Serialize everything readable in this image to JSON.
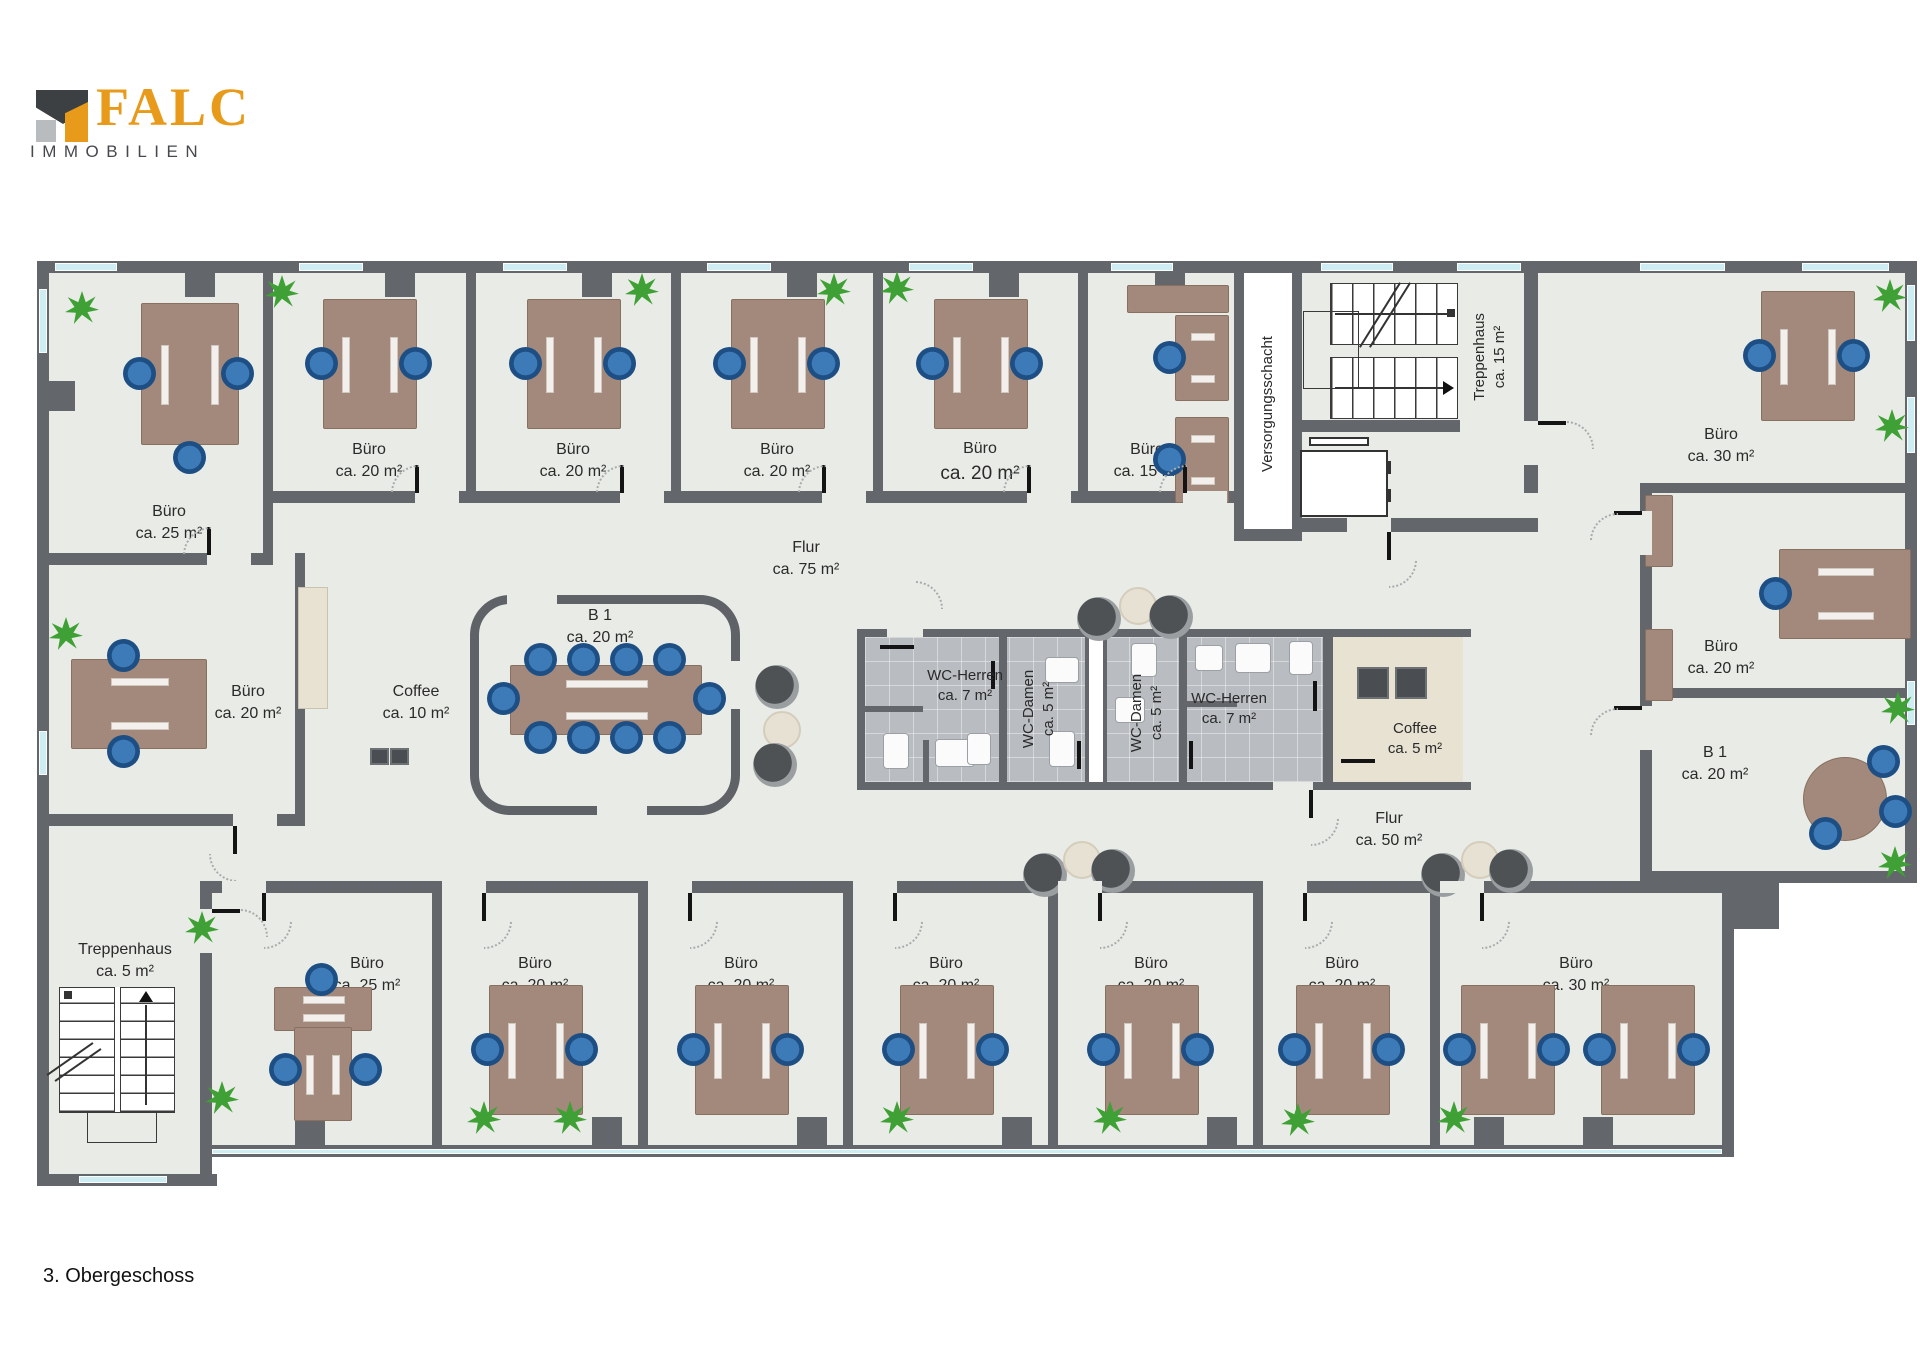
{
  "logo": {
    "brand": "FALC",
    "subtitle": "IMMOBILIEN"
  },
  "floor_label": "3. Obergeschoss",
  "colors": {
    "wall": "#63666a",
    "floor": "#e9ece6",
    "window": "#cdedf3",
    "wc_tile": "#b9bdc2",
    "beige": "#e8e2d3",
    "desk": "#a2897b",
    "chair": "#2e6da8",
    "plant": "#3fa135",
    "logo_orange": "#e89b1b",
    "logo_gray": "#45484d"
  },
  "rooms": {
    "top": [
      {
        "name": "Büro",
        "area": "ca. 25 m²"
      },
      {
        "name": "Büro",
        "area": "ca. 20 m²"
      },
      {
        "name": "Büro",
        "area": "ca. 20 m²"
      },
      {
        "name": "Büro",
        "area": "ca. 20 m²"
      },
      {
        "name": "Büro",
        "area": "ca. 20 m²"
      },
      {
        "name": "Büro",
        "area": "ca. 15 m²"
      }
    ],
    "shaft_label": "Versorgungsschacht",
    "stair_top": {
      "name": "Treppenhaus",
      "area": "ca. 15 m²"
    },
    "top_right": {
      "name": "Büro",
      "area": "ca. 30 m²"
    },
    "right": [
      {
        "name": "Büro",
        "area": "ca. 20 m²"
      },
      {
        "name": "B 1",
        "area": "ca. 20 m²"
      }
    ],
    "middle": [
      {
        "name": "Büro",
        "area": "ca. 20 m²"
      },
      {
        "name": "Coffee",
        "area": "ca. 10 m²"
      },
      {
        "name": "B 1",
        "area": "ca. 20 m²"
      }
    ],
    "wc": [
      {
        "name": "WC-Herren",
        "area": "ca. 7 m²"
      },
      {
        "name": "WC-Damen",
        "area": "ca. 5 m²"
      },
      {
        "name": "WC-Damen",
        "area": "ca. 5 m²"
      },
      {
        "name": "WC-Herren",
        "area": "ca. 7 m²"
      }
    ],
    "coffee_small": {
      "name": "Coffee",
      "area": "ca. 5 m²"
    },
    "corridor_top": {
      "name": "Flur",
      "area": "ca. 75 m²"
    },
    "corridor_bottom": {
      "name": "Flur",
      "area": "ca. 50 m²"
    },
    "stair_bottom": {
      "name": "Treppenhaus",
      "area": "ca. 5 m²"
    },
    "bottom": [
      {
        "name": "Büro",
        "area": "ca. 25 m²"
      },
      {
        "name": "Büro",
        "area": "ca. 20 m²"
      },
      {
        "name": "Büro",
        "area": "ca. 20 m²"
      },
      {
        "name": "Büro",
        "area": "ca. 20 m²"
      },
      {
        "name": "Büro",
        "area": "ca. 20 m²"
      },
      {
        "name": "Büro",
        "area": "ca. 20 m²"
      },
      {
        "name": "Büro",
        "area": "ca. 30 m²"
      }
    ]
  }
}
